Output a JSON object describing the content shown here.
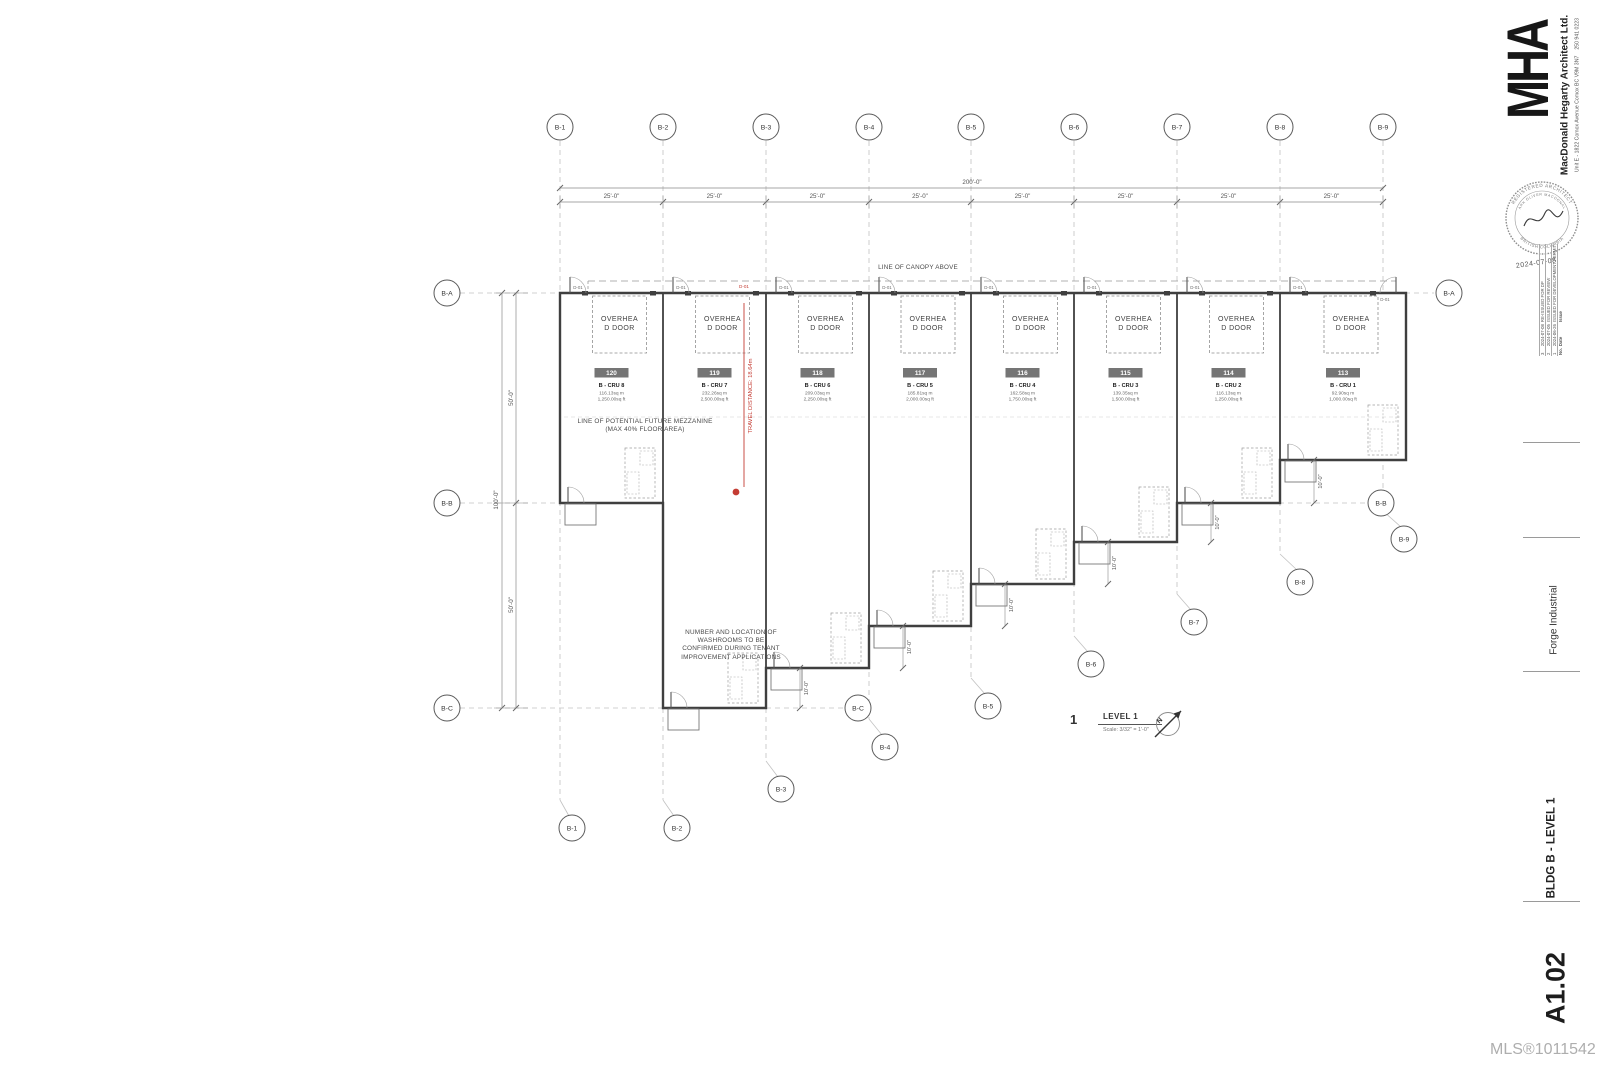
{
  "drawing": {
    "view_title": {
      "number": "1",
      "name": "LEVEL 1",
      "scale": "Scale:  3/32\" = 1'-0\""
    },
    "overhead_door_label": "OVERHEAD DOOR",
    "door_tag": "D-01",
    "dims": {
      "overall_top": "200'-0\"",
      "bay": "25'-0\"",
      "left_total": "100'-0\"",
      "left_half": "50'-0\"",
      "step": "10'-0\""
    },
    "annotations": {
      "canopy": "LINE OF CANOPY ABOVE",
      "mezzanine": "LINE OF POTENTIAL FUTURE MEZZANINE (MAX 40% FLOOR AREA)",
      "washrooms": "NUMBER AND LOCATION OF WASHROOMS TO BE CONFIRMED DURING TENANT IMPROVEMENT APPLICATIONS",
      "travel_distance": "TRAVEL DISTANCE: 18.64m",
      "exit_door_tag": "D-01"
    },
    "units": [
      {
        "number": "120",
        "cru": "B - CRU 8",
        "area_m": "116.13sq m",
        "area_ft": "1,250.00sq ft",
        "x1": 560,
        "x2": 663,
        "bottom": 503
      },
      {
        "number": "119",
        "cru": "B - CRU 7",
        "area_m": "232.26sq m",
        "area_ft": "2,500.00sq ft",
        "x1": 663,
        "x2": 766,
        "bottom": 708
      },
      {
        "number": "118",
        "cru": "B - CRU 6",
        "area_m": "209.03sq m",
        "area_ft": "2,250.00sq ft",
        "x1": 766,
        "x2": 869,
        "bottom": 668
      },
      {
        "number": "117",
        "cru": "B - CRU 5",
        "area_m": "185.81sq m",
        "area_ft": "2,000.00sq ft",
        "x1": 869,
        "x2": 971,
        "bottom": 626
      },
      {
        "number": "116",
        "cru": "B - CRU 4",
        "area_m": "162.58sq m",
        "area_ft": "1,750.00sq ft",
        "x1": 971,
        "x2": 1074,
        "bottom": 584
      },
      {
        "number": "115",
        "cru": "B - CRU 3",
        "area_m": "139.35sq m",
        "area_ft": "1,500.00sq ft",
        "x1": 1074,
        "x2": 1177,
        "bottom": 542
      },
      {
        "number": "114",
        "cru": "B - CRU 2",
        "area_m": "116.13sq m",
        "area_ft": "1,250.00sq ft",
        "x1": 1177,
        "x2": 1280,
        "bottom": 503
      },
      {
        "number": "113",
        "cru": "B - CRU 1",
        "area_m": "92.90sq m",
        "area_ft": "1,000.00sq ft",
        "x1": 1280,
        "x2": 1406,
        "bottom": 460
      }
    ],
    "grid_cols": [
      {
        "id": "B-1",
        "x": 560,
        "bot_y": 828,
        "dx": 12
      },
      {
        "id": "B-2",
        "x": 663,
        "bot_y": 828,
        "dx": 14
      },
      {
        "id": "B-3",
        "x": 766,
        "bot_y": 789,
        "dx": 15
      },
      {
        "id": "B-4",
        "x": 869,
        "bot_y": 747,
        "dx": 16
      },
      {
        "id": "B-5",
        "x": 971,
        "bot_y": 706,
        "dx": 17
      },
      {
        "id": "B-6",
        "x": 1074,
        "bot_y": 664,
        "dx": 17
      },
      {
        "id": "B-7",
        "x": 1177,
        "bot_y": 622,
        "dx": 17
      },
      {
        "id": "B-8",
        "x": 1280,
        "bot_y": 582,
        "dx": 20
      },
      {
        "id": "B-9",
        "x": 1383,
        "bot_y": 539,
        "dx": 21
      }
    ],
    "grid_rows": [
      {
        "id": "B-A",
        "y": 293,
        "x1": 460,
        "x2": 1434,
        "lb": 447,
        "rb": 1449
      },
      {
        "id": "B-B",
        "y": 503,
        "x1": 460,
        "x2": 1366,
        "lb": 447,
        "rb": 1381
      },
      {
        "id": "B-C",
        "y": 708,
        "x1": 460,
        "x2": 843,
        "lb": 447,
        "rb": 858
      }
    ],
    "building": {
      "left": 560,
      "right": 1406,
      "top": 293
    },
    "red": {
      "hex": "#c43c33",
      "dot": [
        736,
        492
      ],
      "line_x": 744,
      "line_y1": 303,
      "line_y2": 487,
      "text_x": 749,
      "text_y": 396,
      "tag_x": 744,
      "tag_y": 288
    }
  },
  "title_block": {
    "logo": "MHA",
    "firm": "MacDonald Hegarty Architect Ltd.",
    "address": "Unit E - 1822 Comox Avenue Comox BC V9M 3N7",
    "phone": "250 941 0223",
    "seal": {
      "top": "REGISTERED ARCHITECT",
      "name": "MARK OLIVER MACDONALD",
      "bottom": "BRITISH COLUMBIA",
      "date": "2024-07-08"
    },
    "revisions": {
      "headers": {
        "no": "No.",
        "date": "Date",
        "issue": "Issue"
      },
      "rows": [
        {
          "no": "3",
          "date": "2024-07-08",
          "issue": "RE-ISSUED FOR DP"
        },
        {
          "no": "2",
          "date": "2024-07-05",
          "issue": "ISSUED FOR REVIEW"
        },
        {
          "no": "1",
          "date": "2024-06-26",
          "issue": "ISSUED FOR DEVELOPMENT PERMIT"
        }
      ]
    },
    "project": "Forge Industrial",
    "sheet_title": "BLDG B - LEVEL 1",
    "sheet_number": "A1.02"
  },
  "watermark": "MLS®1011542",
  "colors": {
    "wall": "#3f3f3f",
    "grid": "#c2c2c2",
    "dim": "#8a8a8a",
    "text": "#4a4a4a",
    "tag_fill": "#757575"
  }
}
